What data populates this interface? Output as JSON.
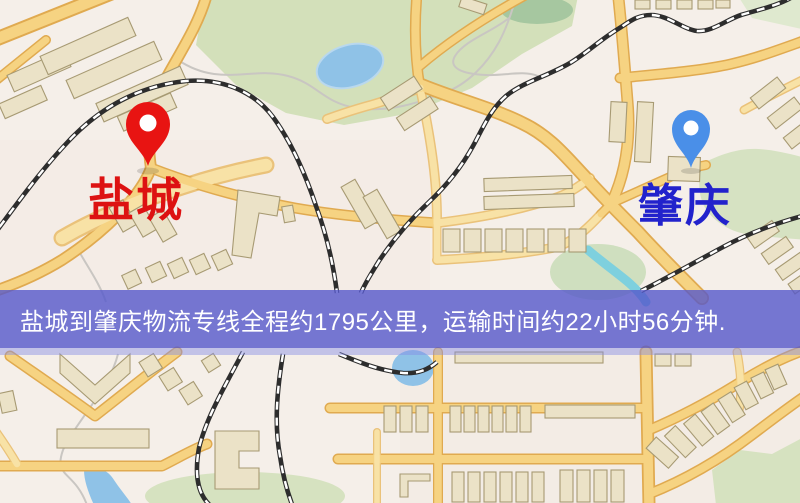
{
  "map": {
    "origin": {
      "label": "盐城",
      "pin_color": "#e81412",
      "label_color": "#dd1212",
      "pin_icon": "red-location-pin"
    },
    "destination": {
      "label": "肇庆",
      "pin_color": "#4a8fe8",
      "label_color": "#2222cc",
      "pin_icon": "blue-location-pin"
    }
  },
  "banner": {
    "text": "盐城到肇庆物流专线全程约1795公里，运输时间约22小时56分钟.",
    "background_color": "#5558ca",
    "text_color": "#ffffff"
  },
  "map_colors": {
    "background": "#f5efe9",
    "road_fill": "#f6d382",
    "road_casing": "#e0aa50",
    "railway": "#2d2d2d",
    "park": "#d3e0ba",
    "water": "#8fc2e7",
    "building": "#ebe2c7"
  }
}
